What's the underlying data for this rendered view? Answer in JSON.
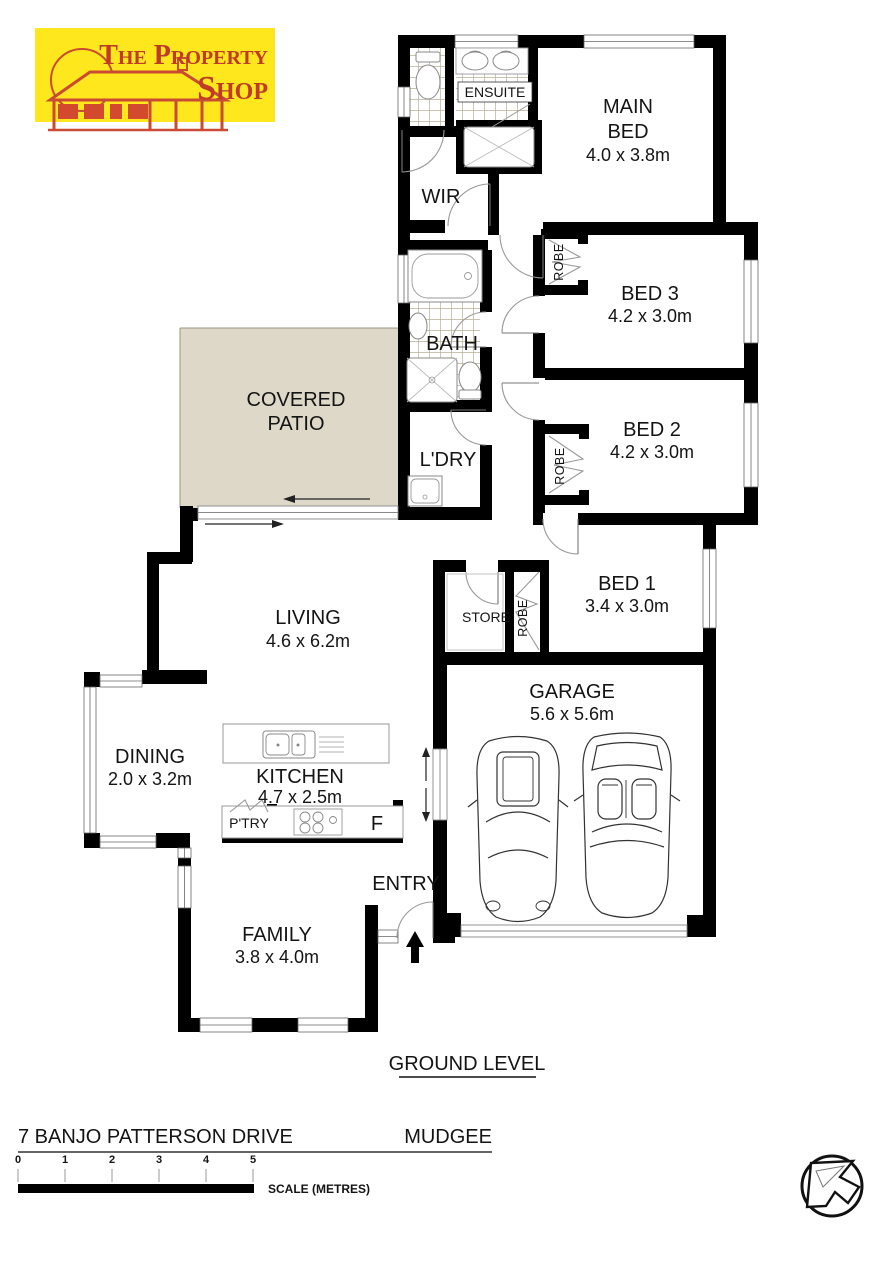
{
  "logo": {
    "line1": "The Property",
    "line2": "Shop",
    "bg_color": "#FFE71E",
    "red_color": "#C03A28"
  },
  "plan": {
    "level_label": "GROUND LEVEL",
    "rooms": {
      "ensuite": {
        "name": "ENSUITE"
      },
      "main_bed": {
        "line1": "MAIN",
        "line2": "BED",
        "dims": "4.0 x 3.8m"
      },
      "wir": {
        "name": "WIR"
      },
      "bed3": {
        "name": "BED 3",
        "dims": "4.2 x 3.0m"
      },
      "bath": {
        "name": "BATH"
      },
      "bed2": {
        "name": "BED 2",
        "dims": "4.2 x 3.0m"
      },
      "patio": {
        "line1": "COVERED",
        "line2": "PATIO"
      },
      "ldry": {
        "name": "L'DRY"
      },
      "robe": {
        "name": "ROBE"
      },
      "bed1": {
        "name": "BED 1",
        "dims": "3.4 x 3.0m"
      },
      "living": {
        "name": "LIVING",
        "dims": "4.6 x 6.2m"
      },
      "store": {
        "name": "STORE"
      },
      "garage": {
        "name": "GARAGE",
        "dims": "5.6 x 5.6m"
      },
      "dining": {
        "name": "DINING",
        "dims": "2.0 x 3.2m"
      },
      "kitchen": {
        "name": "KITCHEN",
        "dims": "4.7 x 2.5m"
      },
      "pantry": {
        "name": "P'TRY"
      },
      "fridge": {
        "name": "F"
      },
      "entry": {
        "name": "ENTRY"
      },
      "family": {
        "name": "FAMILY",
        "dims": "3.8 x 4.0m"
      }
    },
    "colors": {
      "wall": "#000000",
      "patio_fill": "#DDD8C7",
      "tile_line": "#B7B099"
    }
  },
  "footer": {
    "address": "7 BANJO PATTERSON DRIVE",
    "suburb": "MUDGEE",
    "scale": {
      "ticks": [
        "0",
        "1",
        "2",
        "3",
        "4",
        "5"
      ],
      "label": "SCALE (METRES)"
    }
  }
}
